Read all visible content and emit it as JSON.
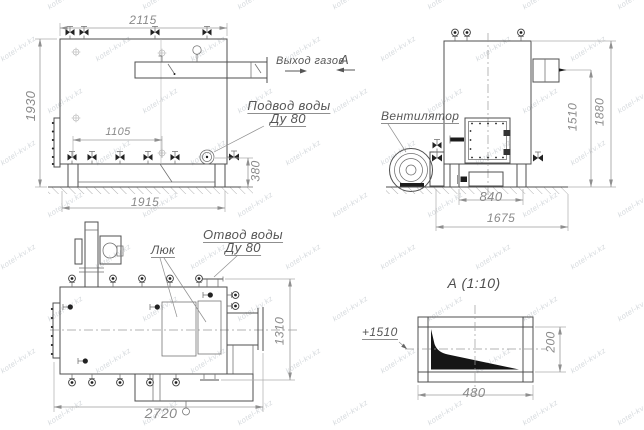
{
  "watermark": {
    "text": "kotel-kv.kz"
  },
  "side_view": {
    "dims": {
      "top_width": "2115",
      "height": "1930",
      "valve_row": "1105",
      "base_length": "1915",
      "inlet_height": "380"
    },
    "labels": {
      "gas_outlet": "Выход газов",
      "section_mark": "А",
      "water_inlet_line1": "Подвод воды",
      "water_inlet_line2": "Ду 80"
    }
  },
  "front_view": {
    "dims": {
      "stub_height": "1510",
      "total_height": "1880",
      "base_width": "840",
      "total_width": "1675"
    },
    "labels": {
      "fan": "Вентилятор"
    }
  },
  "plan_view": {
    "dims": {
      "width": "1310",
      "total_length": "2720"
    },
    "labels": {
      "hatch": "Люк",
      "water_outlet_line1": "Отвод воды",
      "water_outlet_line2": "Ду 80"
    }
  },
  "detail_a": {
    "title": "А (1:10)",
    "elevation": "+1510",
    "dims": {
      "width": "480",
      "height": "200"
    }
  }
}
